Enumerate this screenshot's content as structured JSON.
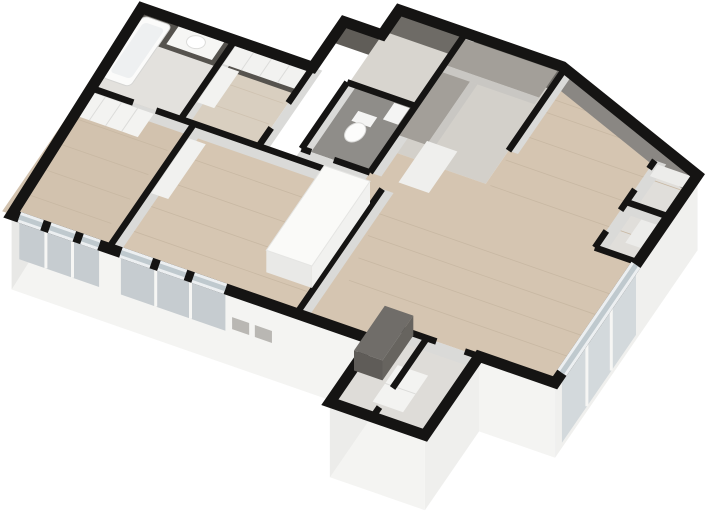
{
  "scene": {
    "title": "3D Floor Plan Render",
    "type": "isometric-dollhouse-floorplan",
    "aria_label": "3D isometric dollhouse render of an apartment floor plan with cut walls shown in black, white exterior facades, wood floors and built-in furniture",
    "background": "#ffffff"
  },
  "colors": {
    "wall_cap": "#151413",
    "dark_inner_wall_west_block": "#56534e",
    "dark_inner_wall_kitchen": "#6e6b66",
    "dark_inner_wall_notch": "#605d58",
    "dark_inner_wall_northeast": "#8a8783",
    "interior_wall_face": "#dadad8",
    "exterior_face_south": "#f4f4f2",
    "exterior_face_west": "#e8e8e6",
    "exterior_face_east": "#f0f0ee",
    "floor_wood_living": "#d5c5b1",
    "floor_wood_bedroom_west": "#d2c2ae",
    "floor_wood_bedroom_middle": "#d6c6b2",
    "floor_wood_closet": "#d9cfc0",
    "floor_tile_bathroom": "#e3e1dd",
    "floor_tile_wc_dark": "#8f8d89",
    "floor_kitchen": "#d3d0ca",
    "floor_corridor": "#d8cec0",
    "floor_entry": "#d8d5cf",
    "floor_storage_east": "#e0deda",
    "floor_utility_south": "#dedcd8",
    "glass": "#c6ccd0",
    "glass_facade_band": "#d3d9dc",
    "furniture_white": "#f3f3f1",
    "furniture_dark_cabinet": "#706d69",
    "countertop_dark": "#a39f99"
  },
  "rooms": [
    {
      "id": "bathroom-northwest",
      "floor": "light-tile",
      "fixtures": [
        "bathtub",
        "washbasin-counter"
      ]
    },
    {
      "id": "walk-in-closet",
      "floor": "wood",
      "fixtures": [
        "wardrobe-units"
      ]
    },
    {
      "id": "bedroom-west",
      "floor": "wood",
      "fixtures": [
        "wardrobe-row"
      ]
    },
    {
      "id": "bedroom-middle",
      "floor": "wood",
      "fixtures": [
        "side-cabinet",
        "tall-wardrobe"
      ]
    },
    {
      "id": "entry-hall",
      "floor": "tile"
    },
    {
      "id": "wc",
      "floor": "dark-tile",
      "fixtures": [
        "toilet",
        "washbasin"
      ]
    },
    {
      "id": "kitchen",
      "floor": "tile",
      "fixtures": [
        "l-shaped-counter",
        "tall-units"
      ]
    },
    {
      "id": "corridor",
      "floor": "wood"
    },
    {
      "id": "living-dining",
      "floor": "wood"
    },
    {
      "id": "storage-east-north",
      "floor": "tile",
      "fixtures": [
        "shelf"
      ]
    },
    {
      "id": "storage-east-south",
      "floor": "tile",
      "fixtures": [
        "shelf"
      ]
    },
    {
      "id": "utility-south",
      "floor": "tile",
      "fixtures": [
        "tall-dark-cabinet",
        "washing-machine"
      ]
    }
  ],
  "windows": [
    {
      "id": "south-window-bedroom-west",
      "style": "floor-to-ceiling glass with piers"
    },
    {
      "id": "south-window-bedroom-middle",
      "style": "floor-to-ceiling glass with piers"
    },
    {
      "id": "southeast-glass-wall",
      "style": "full-height glazing with mullions"
    },
    {
      "id": "facade-slit-windows",
      "style": "two small openings in lower south facade"
    }
  ]
}
